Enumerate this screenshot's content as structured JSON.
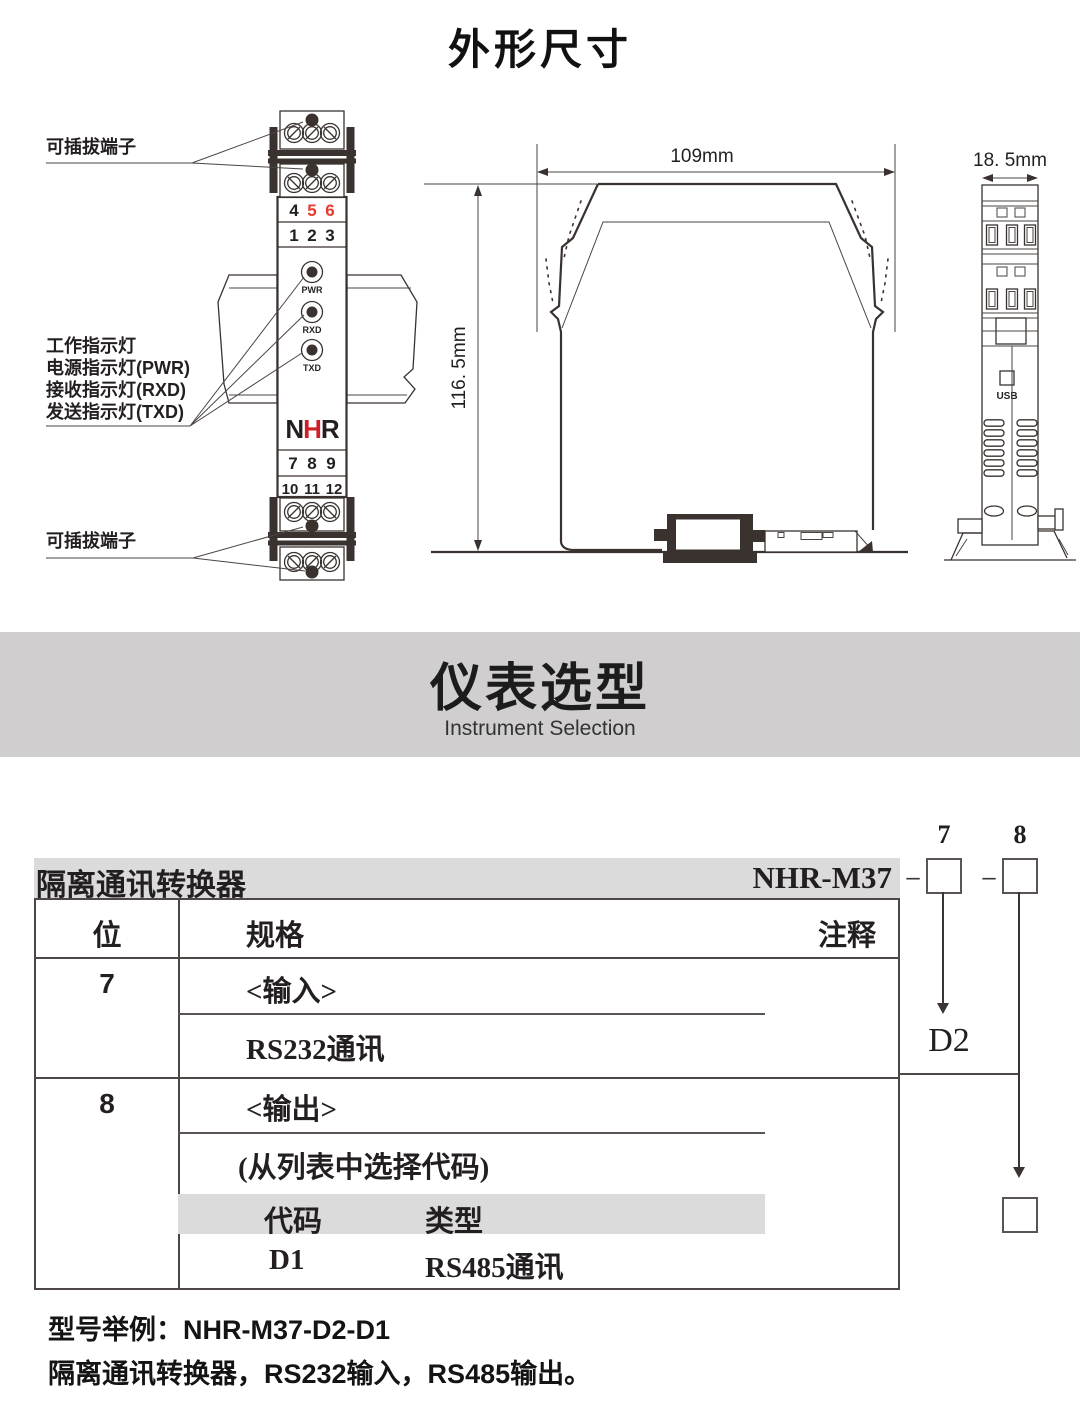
{
  "page": {
    "title": "外形尺寸"
  },
  "front_view": {
    "label_pluggable_top": "可插拔端子",
    "label_pluggable_bottom": "可插拔端子",
    "indicator_labels": [
      "工作指示灯",
      "电源指示灯(PWR)",
      "接收指示灯(RXD)",
      "发送指示灯(TXD)"
    ],
    "terminals": {
      "row1": [
        "4",
        "5",
        "6"
      ],
      "row2": [
        "1",
        "2",
        "3"
      ],
      "row3": [
        "7",
        "8",
        "9"
      ],
      "row4": [
        "10",
        "11",
        "12"
      ]
    },
    "leds": [
      "PWR",
      "RXD",
      "TXD"
    ],
    "logo": {
      "n": "N",
      "h": "H",
      "r": "R"
    }
  },
  "side_view": {
    "width_label": "109mm",
    "height_label": "116. 5mm"
  },
  "profile_view": {
    "width_label": "18. 5mm",
    "usb_label": "USB"
  },
  "banner": {
    "title": "仪表选型",
    "subtitle": "Instrument Selection"
  },
  "selection": {
    "product_name": "隔离通讯转换器",
    "model": "NHR-M37",
    "dash": "–",
    "digit7": "7",
    "digit8": "8",
    "note7": "D2",
    "table": {
      "header_position": "位",
      "header_spec": "规格",
      "header_note": "注释",
      "row7": {
        "position": "7",
        "spec_title": "<输入>",
        "spec_value": "RS232通讯"
      },
      "row8": {
        "position": "8",
        "spec_title": "<输出>",
        "spec_hint": "(从列表中选择代码)",
        "code_header": "代码",
        "type_header": "类型",
        "code": "D1",
        "type": "RS485通讯"
      }
    },
    "example_line1": "型号举例：NHR-M37-D2-D1",
    "example_line2": "隔离通讯转换器，RS232输入，RS485输出。"
  },
  "colors": {
    "red": "#e8392e",
    "logo_red": "#cf1f26",
    "banner_gray": "#d0cece",
    "bar_gray": "#dcdbdb",
    "line_dark": "#39322f"
  }
}
